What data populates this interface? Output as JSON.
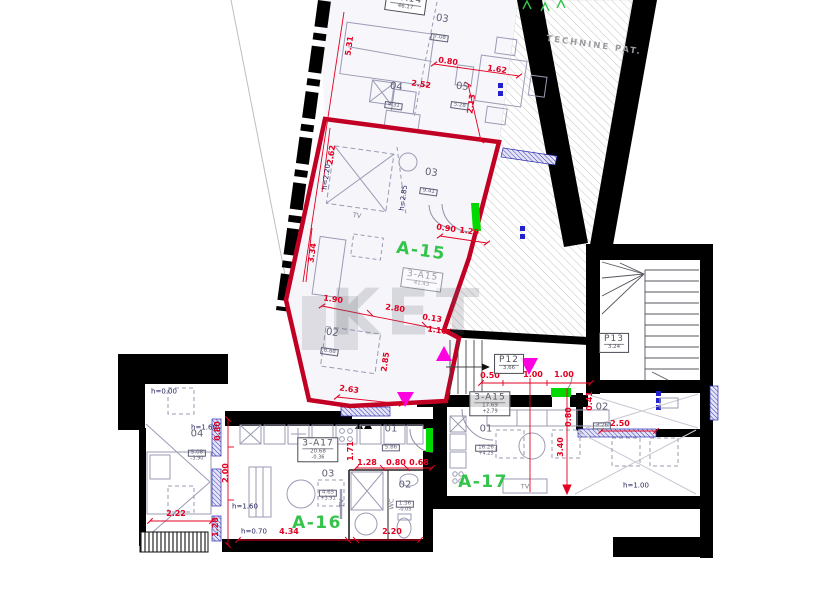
{
  "watermark": "KET",
  "colors": {
    "dimension_red": "#e30021",
    "outline_red": "#c10024",
    "unit_green": "#35c44b",
    "door_green": "#00d900",
    "marker_magenta": "#ff00e1",
    "window_blue": "#2b2bb0",
    "wall_black": "#000000",
    "hatch_gray": "#c2c2c2"
  },
  "technical_room_label": {
    "t": "TECHNINE PAT.",
    "x": 594,
    "y": 46,
    "r": 8
  },
  "green_unit_labels": [
    {
      "t": "A-15",
      "x": 421,
      "y": 252,
      "r": 8
    },
    {
      "t": "A-16",
      "x": 317,
      "y": 524,
      "r": 0
    },
    {
      "t": "A-17",
      "x": 483,
      "y": 483,
      "r": 0
    }
  ],
  "unit_info_boxes": [
    {
      "label": "1-A14",
      "area": "46.17",
      "level": "",
      "x": 406,
      "y": 3,
      "r": 8,
      "faint": false
    },
    {
      "label": "3-A15",
      "area": "41.43",
      "level": "",
      "x": 422,
      "y": 280,
      "r": 8,
      "faint": true
    },
    {
      "label": "3-A17",
      "area": "20.68",
      "level": "-0.36",
      "x": 318,
      "y": 450,
      "r": 0,
      "faint": false
    },
    {
      "label": "3-A15",
      "area": "17.69",
      "level": "+2.79",
      "x": 490,
      "y": 404,
      "r": 0,
      "faint": false
    },
    {
      "label": "P12",
      "area": "3.66",
      "level": "",
      "x": 509,
      "y": 364,
      "r": 0,
      "faint": false
    },
    {
      "label": "P13",
      "area": "3.24",
      "level": "",
      "x": 614,
      "y": 343,
      "r": 0,
      "faint": false
    }
  ],
  "room_labels": [
    {
      "num": "03",
      "area": "7.08",
      "level": "",
      "x": 441,
      "y": 28,
      "r": 8
    },
    {
      "num": "04",
      "area": "4.31",
      "level": "",
      "x": 395,
      "y": 96,
      "r": 8
    },
    {
      "num": "05",
      "area": "5.28",
      "level": "",
      "x": 461,
      "y": 96,
      "r": 8
    },
    {
      "num": "03",
      "area": "9.41",
      "level": "",
      "x": 430,
      "y": 182,
      "r": 8
    },
    {
      "num": "02",
      "area": "8.88",
      "level": "",
      "x": 331,
      "y": 342,
      "r": 8
    },
    {
      "num": "01",
      "area": "5.86",
      "level": "",
      "x": 391,
      "y": 438,
      "r": 0
    },
    {
      "num": "02",
      "area": "1.36",
      "level": "-0.05",
      "x": 405,
      "y": 497,
      "r": 0
    },
    {
      "num": "03",
      "area": "4.65",
      "level": "+3.91",
      "x": 328,
      "y": 486,
      "r": 0
    },
    {
      "num": "04",
      "area": "5.08",
      "level": "-3.90",
      "x": 197,
      "y": 446,
      "r": 0
    },
    {
      "num": "01",
      "area": "16.26",
      "level": "+4.25",
      "x": 486,
      "y": 441,
      "r": 0
    },
    {
      "num": "02",
      "area": "3.26",
      "level": "",
      "x": 602,
      "y": 416,
      "r": 0
    }
  ],
  "dimensions": [
    {
      "t": "5.31",
      "x": 350,
      "y": 46,
      "r": -82
    },
    {
      "t": "2.62",
      "x": 332,
      "y": 155,
      "r": -82
    },
    {
      "t": "3.34",
      "x": 313,
      "y": 253,
      "r": -82
    },
    {
      "t": "2.13",
      "x": 472,
      "y": 104,
      "r": -82
    },
    {
      "t": "2.52",
      "x": 421,
      "y": 85,
      "r": 8
    },
    {
      "t": "0.80",
      "x": 448,
      "y": 62,
      "r": 8
    },
    {
      "t": "1.62",
      "x": 497,
      "y": 70,
      "r": 8
    },
    {
      "t": "0.90",
      "x": 446,
      "y": 229,
      "r": 8
    },
    {
      "t": "1.20",
      "x": 469,
      "y": 232,
      "r": 8
    },
    {
      "t": "1.90",
      "x": 333,
      "y": 300,
      "r": 8
    },
    {
      "t": "2.80",
      "x": 395,
      "y": 309,
      "r": 8
    },
    {
      "t": "0.13",
      "x": 432,
      "y": 319,
      "r": 8
    },
    {
      "t": "1.10",
      "x": 437,
      "y": 331,
      "r": 8
    },
    {
      "t": "2.85",
      "x": 386,
      "y": 362,
      "r": -82
    },
    {
      "t": "2.63",
      "x": 349,
      "y": 390,
      "r": 8
    },
    {
      "t": "0.50",
      "x": 490,
      "y": 376,
      "r": 0
    },
    {
      "t": "1.00",
      "x": 533,
      "y": 375,
      "r": 0
    },
    {
      "t": "1.00",
      "x": 564,
      "y": 375,
      "r": 0
    },
    {
      "t": "0.80",
      "x": 569,
      "y": 417,
      "r": -90
    },
    {
      "t": "0.41",
      "x": 590,
      "y": 401,
      "r": -90
    },
    {
      "t": "3.40",
      "x": 561,
      "y": 447,
      "r": -90
    },
    {
      "t": "2.50",
      "x": 620,
      "y": 424,
      "r": 0
    },
    {
      "t": "1.28",
      "x": 367,
      "y": 463,
      "r": 0
    },
    {
      "t": "0.80",
      "x": 396,
      "y": 463,
      "r": 0
    },
    {
      "t": "0.68",
      "x": 419,
      "y": 463,
      "r": 0
    },
    {
      "t": "1.71",
      "x": 351,
      "y": 451,
      "r": -90
    },
    {
      "t": "0.80",
      "x": 218,
      "y": 431,
      "r": -90
    },
    {
      "t": "2.00",
      "x": 226,
      "y": 473,
      "r": -90
    },
    {
      "t": "1.28",
      "x": 216,
      "y": 527,
      "r": -90
    },
    {
      "t": "2.22",
      "x": 176,
      "y": 514,
      "r": 0
    },
    {
      "t": "4.34",
      "x": 289,
      "y": 532,
      "r": 0
    },
    {
      "t": "2.20",
      "x": 392,
      "y": 532,
      "r": 0
    }
  ],
  "height_labels": [
    {
      "t": "h=0.00",
      "x": 164,
      "y": 392,
      "r": 0
    },
    {
      "t": "h=1.60",
      "x": 204,
      "y": 428,
      "r": 0
    },
    {
      "t": "h=1.60",
      "x": 245,
      "y": 507,
      "r": 0
    },
    {
      "t": "h=0.70",
      "x": 254,
      "y": 532,
      "r": 0
    },
    {
      "t": "h=1.00",
      "x": 636,
      "y": 486,
      "r": 0
    },
    {
      "t": "h=2.85",
      "x": 404,
      "y": 198,
      "r": -82
    },
    {
      "t": "h=2.20",
      "x": 327,
      "y": 177,
      "r": -82
    }
  ],
  "misc_labels": [
    {
      "t": "TV",
      "x": 357,
      "y": 216,
      "r": 8
    },
    {
      "t": "TV",
      "x": 525,
      "y": 487,
      "r": 0
    },
    {
      "t": "TV",
      "x": 342,
      "y": 503,
      "r": -90
    },
    {
      "t": "WC",
      "x": 392,
      "y": 504,
      "r": -90
    }
  ]
}
